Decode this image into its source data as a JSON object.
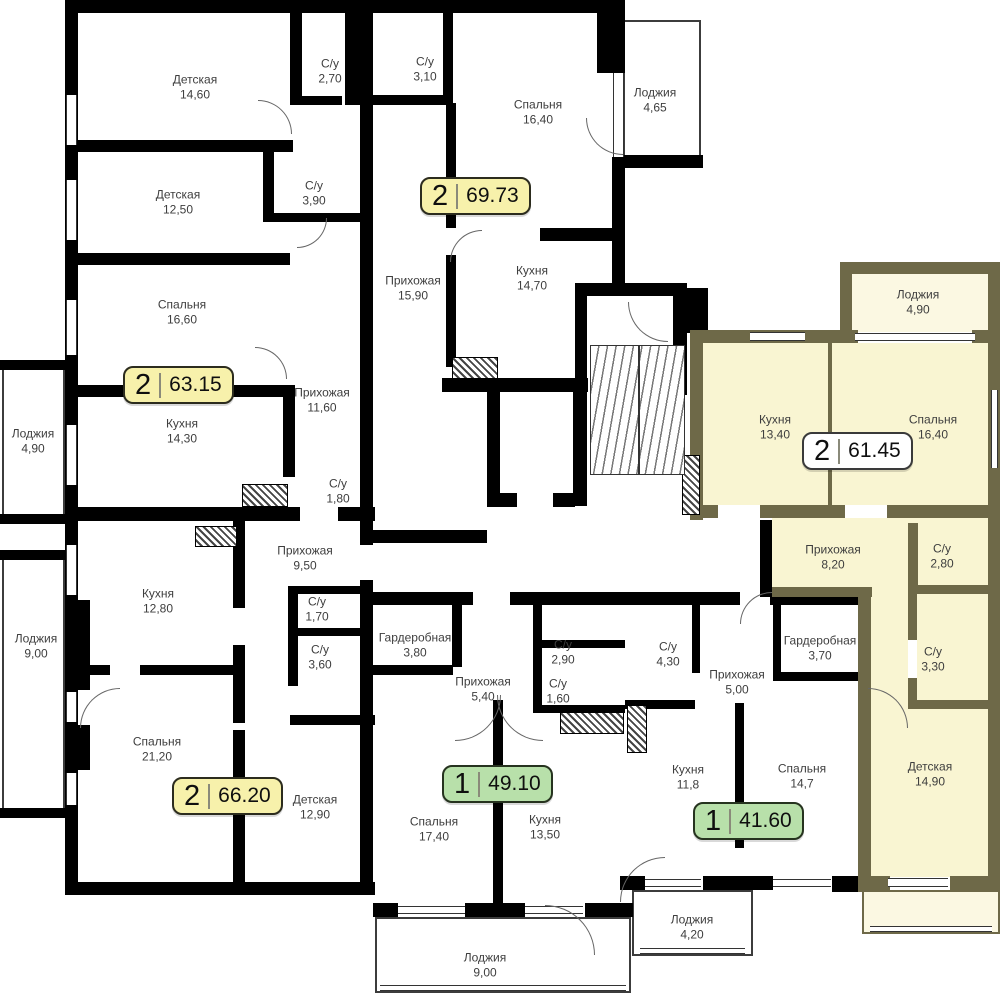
{
  "plan": {
    "type": "residential-floor-plan",
    "language": "ru"
  },
  "colors": {
    "wall": "#000000",
    "highlight_wall": "#6e6948",
    "highlight_room_fill": "#f9f5d2",
    "badge_yellow": "#f7f1ab",
    "badge_green": "#b8e0aa",
    "badge_white": "#ffffff",
    "label_text": "#3e3e3e"
  },
  "apartments": [
    {
      "rooms_count": "2",
      "area": "69.73",
      "badge_style": "yellow",
      "highlighted": false
    },
    {
      "rooms_count": "2",
      "area": "63.15",
      "badge_style": "yellow",
      "highlighted": false
    },
    {
      "rooms_count": "2",
      "area": "66.20",
      "badge_style": "yellow",
      "highlighted": false
    },
    {
      "rooms_count": "2",
      "area": "61.45",
      "badge_style": "white",
      "highlighted": true
    },
    {
      "rooms_count": "1",
      "area": "49.10",
      "badge_style": "green",
      "highlighted": false
    },
    {
      "rooms_count": "1",
      "area": "41.60",
      "badge_style": "green",
      "highlighted": false
    }
  ],
  "rooms": [
    {
      "name": "Детская",
      "area": "14,60",
      "x": 195,
      "y": 88
    },
    {
      "name": "С/у",
      "area": "2,70",
      "x": 330,
      "y": 72
    },
    {
      "name": "С/у",
      "area": "3,10",
      "x": 425,
      "y": 70
    },
    {
      "name": "Спальня",
      "area": "16,40",
      "x": 538,
      "y": 113
    },
    {
      "name": "Лоджия",
      "area": "4,65",
      "x": 655,
      "y": 101
    },
    {
      "name": "Детская",
      "area": "12,50",
      "x": 178,
      "y": 203
    },
    {
      "name": "С/у",
      "area": "3,90",
      "x": 314,
      "y": 194
    },
    {
      "name": "Спальня",
      "area": "16,60",
      "x": 182,
      "y": 313
    },
    {
      "name": "Прихожая",
      "area": "15,90",
      "x": 413,
      "y": 289
    },
    {
      "name": "Кухня",
      "area": "14,70",
      "x": 532,
      "y": 279
    },
    {
      "name": "Прихожая",
      "area": "11,60",
      "x": 322,
      "y": 401
    },
    {
      "name": "Лоджия",
      "area": "4,90",
      "x": 33,
      "y": 442
    },
    {
      "name": "Кухня",
      "area": "14,30",
      "x": 182,
      "y": 432
    },
    {
      "name": "С/у",
      "area": "1,80",
      "x": 338,
      "y": 492
    },
    {
      "name": "Кухня",
      "area": "13,40",
      "x": 775,
      "y": 428
    },
    {
      "name": "Спальня",
      "area": "16,40",
      "x": 933,
      "y": 428
    },
    {
      "name": "Лоджия",
      "area": "4,90",
      "x": 918,
      "y": 303
    },
    {
      "name": "Прихожая",
      "area": "8,20",
      "x": 833,
      "y": 558
    },
    {
      "name": "С/у",
      "area": "2,80",
      "x": 942,
      "y": 557
    },
    {
      "name": "С/у",
      "area": "3,30",
      "x": 933,
      "y": 660
    },
    {
      "name": "Гардеробная",
      "area": "3,70",
      "x": 820,
      "y": 649
    },
    {
      "name": "Детская",
      "area": "14,90",
      "x": 930,
      "y": 775
    },
    {
      "name": "Кухня",
      "area": "12,80",
      "x": 158,
      "y": 602
    },
    {
      "name": "Прихожая",
      "area": "9,50",
      "x": 305,
      "y": 559
    },
    {
      "name": "С/у",
      "area": "1,70",
      "x": 317,
      "y": 610
    },
    {
      "name": "С/у",
      "area": "3,60",
      "x": 320,
      "y": 658
    },
    {
      "name": "Лоджия",
      "area": "9,00",
      "x": 36,
      "y": 647
    },
    {
      "name": "Спальня",
      "area": "21,20",
      "x": 157,
      "y": 750
    },
    {
      "name": "Детская",
      "area": "12,90",
      "x": 315,
      "y": 808
    },
    {
      "name": "Гардеробная",
      "area": "3,80",
      "x": 415,
      "y": 646
    },
    {
      "name": "Прихожая",
      "area": "5,40",
      "x": 483,
      "y": 690
    },
    {
      "name": "С/у",
      "area": "2,90",
      "x": 563,
      "y": 653
    },
    {
      "name": "С/у",
      "area": "1,60",
      "x": 558,
      "y": 692
    },
    {
      "name": "Спальня",
      "area": "17,40",
      "x": 434,
      "y": 830
    },
    {
      "name": "Кухня",
      "area": "13,50",
      "x": 545,
      "y": 828
    },
    {
      "name": "Лоджия",
      "area": "9,00",
      "x": 485,
      "y": 966
    },
    {
      "name": "С/у",
      "area": "4,30",
      "x": 668,
      "y": 655
    },
    {
      "name": "Прихожая",
      "area": "5,00",
      "x": 737,
      "y": 683
    },
    {
      "name": "Кухня",
      "area": "11,8",
      "x": 688,
      "y": 778
    },
    {
      "name": "Спальня",
      "area": "14,7",
      "x": 802,
      "y": 777
    },
    {
      "name": "Лоджия",
      "area": "4,20",
      "x": 692,
      "y": 928
    }
  ]
}
